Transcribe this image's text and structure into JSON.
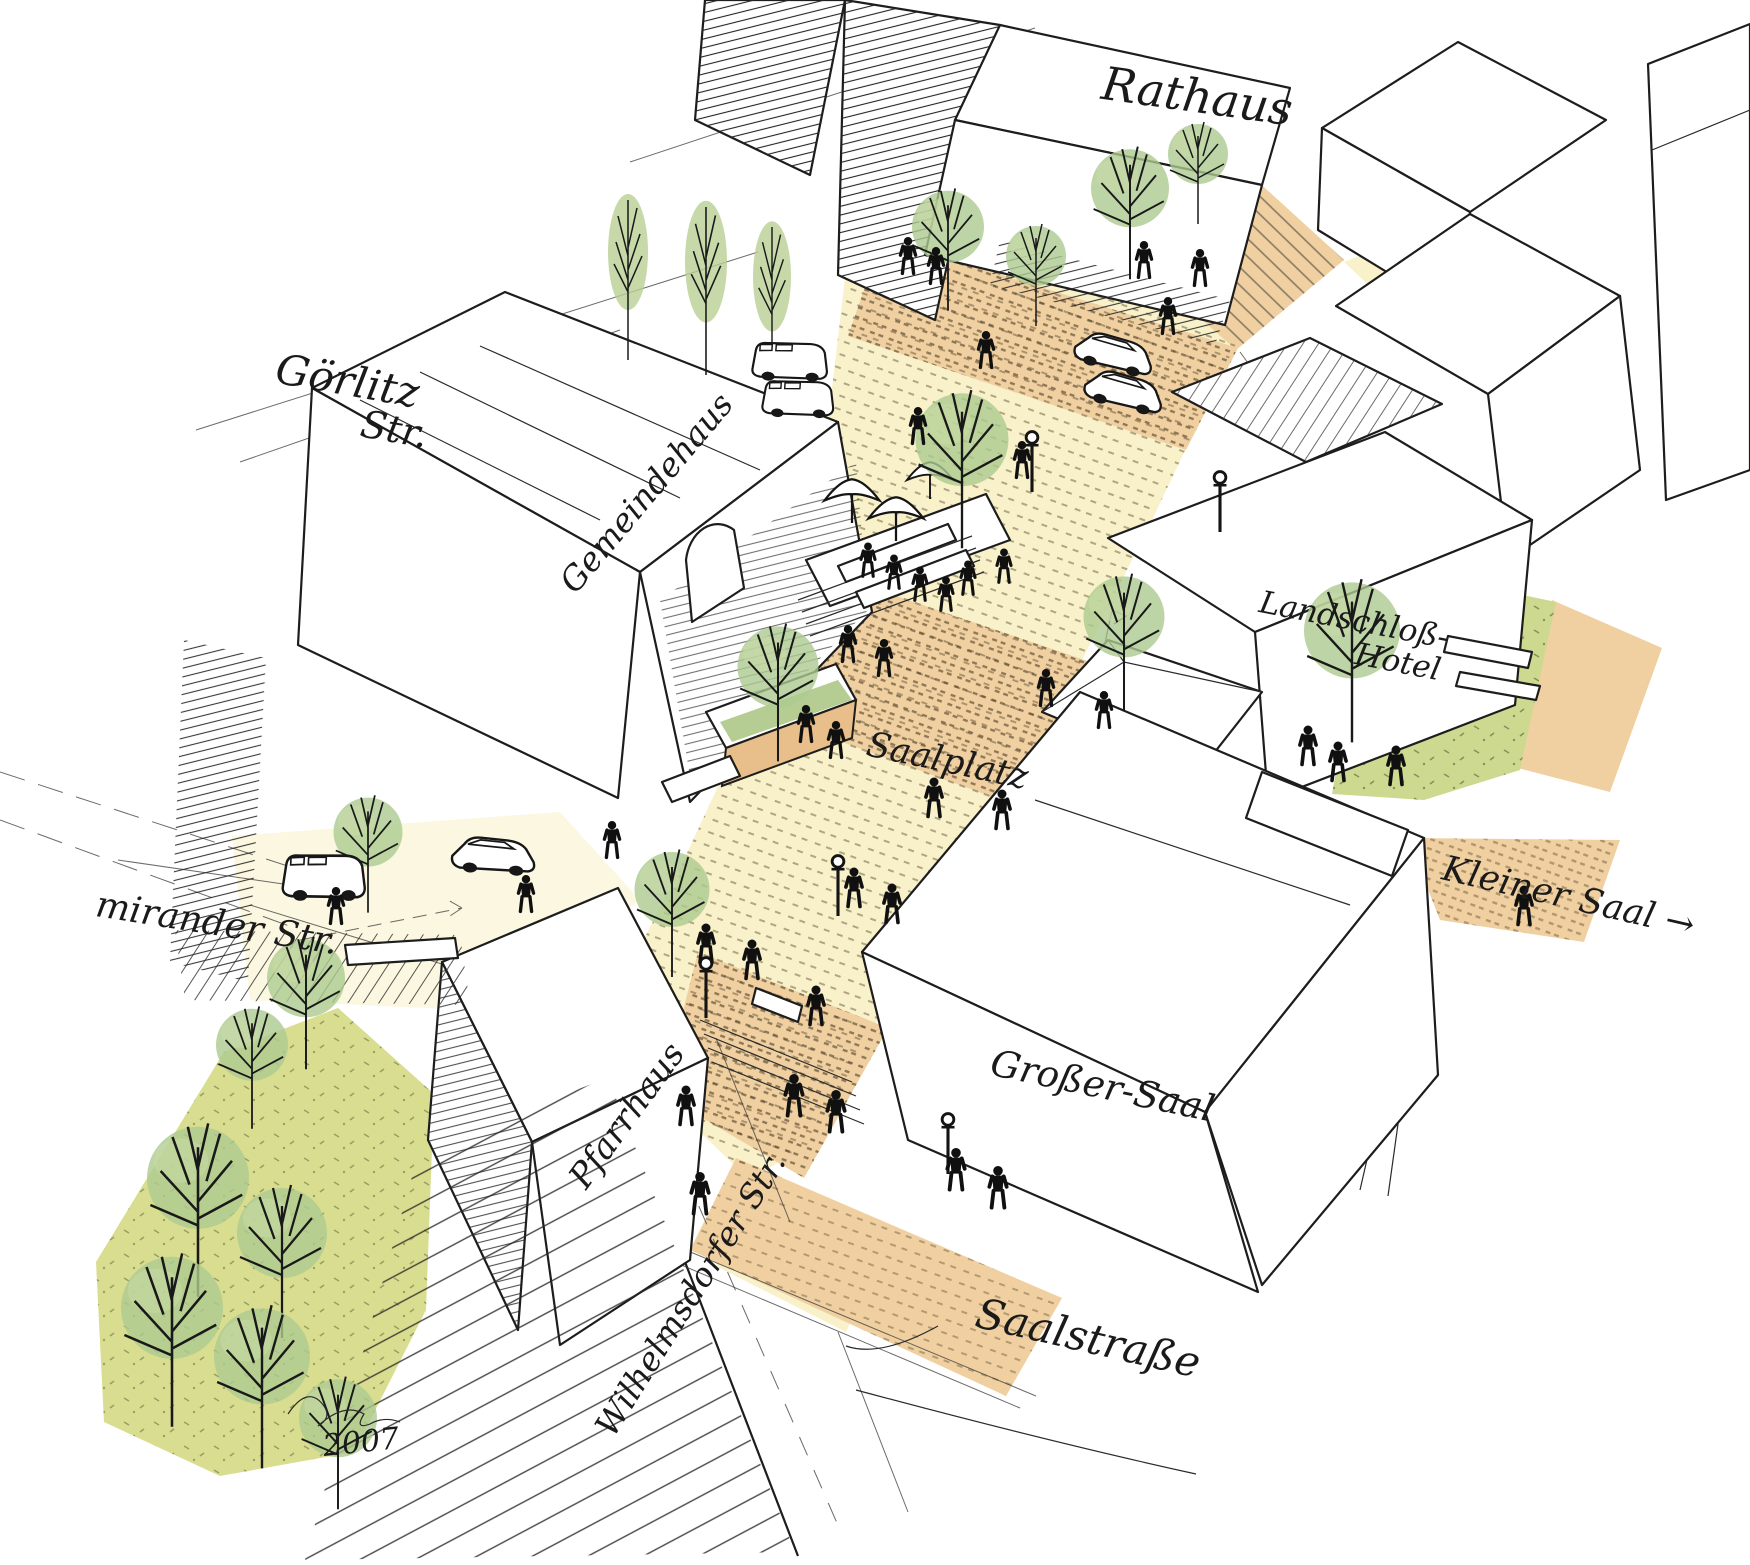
{
  "labels": {
    "rathaus": "Rathaus",
    "goerlitz_str": [
      "Görlitz",
      "Str."
    ],
    "gemeindehaus": "Gemeindehaus",
    "landschloss_hotel": [
      "Landschloß-",
      "Hotel"
    ],
    "saalplatz": "Saalplatz",
    "kleiner_saal": "Kleiner Saal →",
    "mirander_str": "mirander Str.",
    "pfarrhaus": "Pfarrhaus",
    "grosser_saal": "Großer-Saal",
    "wilhelmsdorfer_str": "Wilhelmsdorfer Str.",
    "saalstrasse": "Saalstraße",
    "signature_year": "2007"
  },
  "colors": {
    "ink": "#1c1c1c",
    "paving_cream": "#f8f1c9",
    "paving_tan": "#f0d0a0",
    "lawn_yellow_green": "#d9dd8f",
    "lawn_green": "#ccd98f",
    "tree_green": "#adca90",
    "planter_wall_tan": "#e8bf8a"
  }
}
